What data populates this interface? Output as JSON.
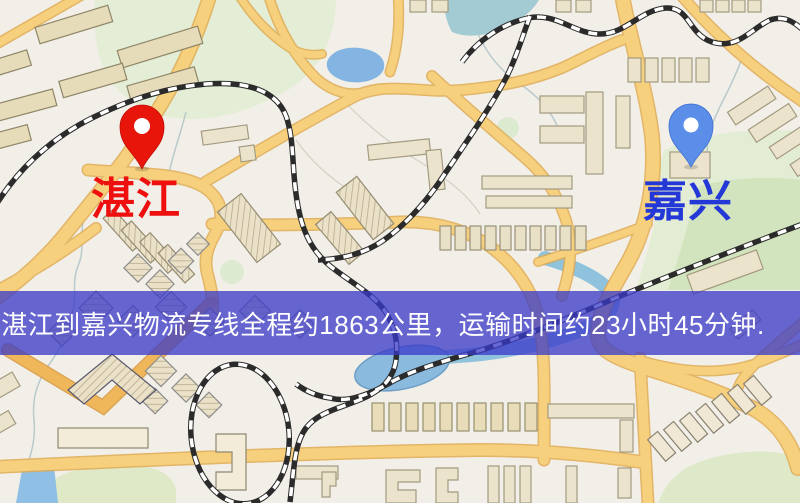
{
  "map": {
    "origin_label": "湛江",
    "destination_label": "嘉兴",
    "origin_pin_color": "#e8150b",
    "origin_pin_stroke": "#c00d06",
    "origin_label_color": "#ee0f0f",
    "destination_pin_color": "#5b8ee8",
    "destination_pin_stroke": "#3f6fd0",
    "destination_label_color": "#2438d8"
  },
  "banner": {
    "text": "湛江到嘉兴物流专线全程约1863公里，运输时间约23小时45分钟.",
    "background_color": "#3a3ac8",
    "text_color": "#ffffff",
    "distance_km": "1863",
    "duration_text": "23小时45分钟"
  }
}
